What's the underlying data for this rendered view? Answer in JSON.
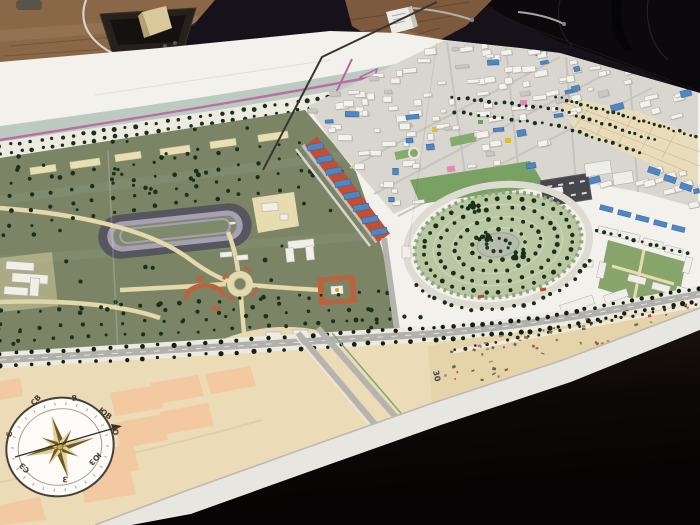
{
  "scene": {
    "compass": {
      "labels": {
        "n": "С",
        "ne": "СВ",
        "e": "В",
        "se": "ЮВ",
        "s": "Ю",
        "sw": "ЮЗ",
        "w": "З",
        "nw": "СЗ"
      }
    },
    "map": {
      "plot_number": "30"
    }
  },
  "colors": {
    "board_white": "#f3f1ec",
    "park_green": "#7b8566",
    "circle_park_green": "#b9c7a3",
    "canal_green": "#bccabf",
    "boundary_magenta": "#b864a4",
    "commercial_red": "#c14f35",
    "building_blue": "#4f86c4",
    "path_cream": "#e4d9ab",
    "farmland_tan": "#ebdbb7",
    "plot_orange": "#f2c9a0",
    "track_gray": "#56565e",
    "track_inner_lavender": "#a79fb4",
    "wood_brown": "#8a6746",
    "chair_black": "#0b090c",
    "tree_dark": "#1c2f1b",
    "board_edge": "#e8e6e1"
  }
}
